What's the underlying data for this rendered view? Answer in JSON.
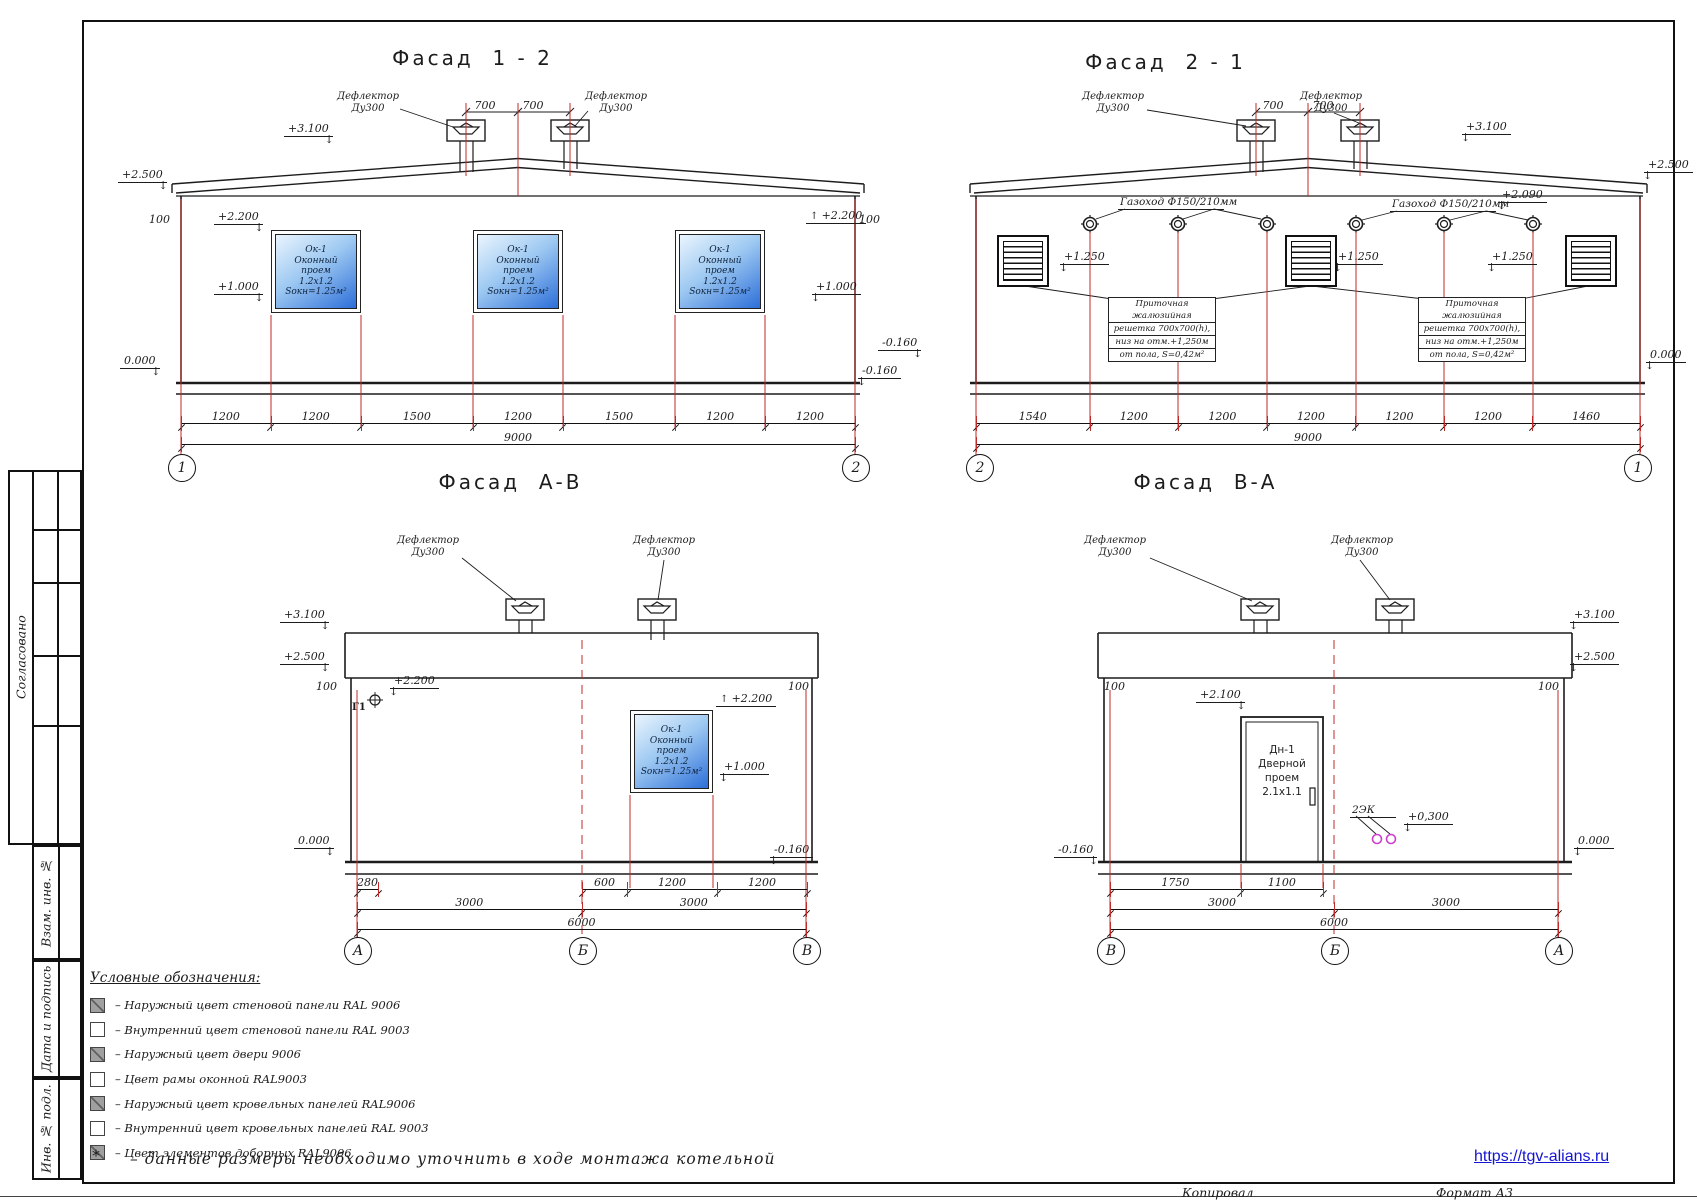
{
  "colors": {
    "axis_red": "#c22a2a",
    "magenta": "#cc3fcc",
    "window_blue_top": "#eaf5fe",
    "window_blue_bottom": "#2d6fd9",
    "link_blue": "#1515d0"
  },
  "sidebar": {
    "agreed": "Согласовано",
    "vzam": "Взам. инв. №",
    "date_sign": "Дата и подпись",
    "inv": "Инв. № подл."
  },
  "legend": {
    "title": "Условные обозначения:",
    "items": [
      {
        "swatch": "gray",
        "label": "–  Наружный цвет стеновой панели RAL 9006"
      },
      {
        "swatch": "white",
        "label": "–  Внутренний цвет стеновой панели RAL  9003"
      },
      {
        "swatch": "gray",
        "label": "–  Наружный цвет двери 9006"
      },
      {
        "swatch": "white",
        "label": "–  Цвет рамы оконной RAL9003"
      },
      {
        "swatch": "gray",
        "label": "–  Наружный цвет кровельных панелей  RAL9006"
      },
      {
        "swatch": "white",
        "label": "–  Внутренний цвет кровельных панелей RAL 9003"
      },
      {
        "swatch": "gray",
        "label": "–  Цвет элементов доборных RAL9006"
      }
    ]
  },
  "windows": [
    {
      "x": 271,
      "y": 230,
      "w": 90,
      "h": 83,
      "lines": [
        "Ок-1",
        "Оконный",
        "проем",
        "1.2х1.2",
        "Sокн=1.25м²"
      ]
    },
    {
      "x": 473,
      "y": 230,
      "w": 90,
      "h": 83,
      "lines": [
        "Ок-1",
        "Оконный",
        "проем",
        "1.2х1.2",
        "Sокн=1.25м²"
      ]
    },
    {
      "x": 675,
      "y": 230,
      "w": 90,
      "h": 83,
      "lines": [
        "Ок-1",
        "Оконный",
        "проем",
        "1.2х1.2",
        "Sокн=1.25м²"
      ]
    },
    {
      "x": 630,
      "y": 710,
      "w": 83,
      "h": 83,
      "lines": [
        "Ок-1",
        "Оконный",
        "проем",
        "1.2х1.2",
        "Sокн=1.25м²"
      ]
    }
  ],
  "door": {
    "x": 1241,
    "y": 717,
    "w": 82,
    "h": 145,
    "lines": [
      "Дн-1",
      "Дверной",
      "проем",
      "2.1х1.1"
    ]
  },
  "grilles": [
    {
      "x": 997,
      "y": 235
    },
    {
      "x": 1285,
      "y": 235
    },
    {
      "x": 1565,
      "y": 235
    }
  ],
  "callouts": [
    {
      "x": 1108,
      "y": 297,
      "rows": [
        "Приточная жалюзийная",
        "решетка 700х700(h),",
        "низ на отм.+1,250м",
        "от пола, S=0,42м²"
      ]
    },
    {
      "x": 1418,
      "y": 297,
      "rows": [
        "Приточная жалюзийная",
        "решетка 700х700(h),",
        "низ на отм.+1,250м",
        "от пола, S=0,42м²"
      ]
    }
  ],
  "axis_markers": [
    {
      "x": 181,
      "y": 467,
      "label": "1"
    },
    {
      "x": 855,
      "y": 467,
      "label": "2"
    },
    {
      "x": 979,
      "y": 467,
      "label": "2"
    },
    {
      "x": 1637,
      "y": 467,
      "label": "1"
    },
    {
      "x": 357,
      "y": 950,
      "label": "А"
    },
    {
      "x": 582,
      "y": 950,
      "label": "Б"
    },
    {
      "x": 806,
      "y": 950,
      "label": "В"
    },
    {
      "x": 1110,
      "y": 950,
      "label": "В"
    },
    {
      "x": 1334,
      "y": 950,
      "label": "Б"
    },
    {
      "x": 1558,
      "y": 950,
      "label": "А"
    }
  ],
  "dim_rows": [
    {
      "x": 181,
      "y": 410,
      "w": 674,
      "values": [
        1200,
        1200,
        1500,
        1200,
        1500,
        1200,
        1200
      ]
    },
    {
      "x": 181,
      "y": 431,
      "w": 674,
      "values": [
        9000
      ]
    },
    {
      "x": 976,
      "y": 410,
      "w": 664,
      "values": [
        1540,
        1200,
        1200,
        1200,
        1200,
        1200,
        1460
      ]
    },
    {
      "x": 976,
      "y": 431,
      "w": 664,
      "values": [
        9000
      ]
    },
    {
      "x": 357,
      "y": 876,
      "w": 21,
      "values": [
        280
      ]
    },
    {
      "x": 582,
      "y": 876,
      "w": 225,
      "values": [
        600,
        1200,
        1200
      ]
    },
    {
      "x": 357,
      "y": 896,
      "w": 449,
      "values": [
        3000,
        3000
      ]
    },
    {
      "x": 357,
      "y": 916,
      "w": 449,
      "values": [
        6000
      ]
    },
    {
      "x": 1110,
      "y": 876,
      "w": 213,
      "values": [
        1750,
        1100
      ]
    },
    {
      "x": 1110,
      "y": 896,
      "w": 448,
      "values": [
        3000,
        3000
      ]
    },
    {
      "x": 1110,
      "y": 916,
      "w": 448,
      "values": [
        6000
      ]
    }
  ],
  "annotations": [
    {
      "n": "facade-title-1-2",
      "t": "Фасад  1 - 2",
      "x": 375,
      "y": 46,
      "w": 195,
      "cls": "title"
    },
    {
      "n": "deflector-label",
      "t": "Дефлектор\nДу300",
      "x": 336,
      "y": 91,
      "w": 64,
      "cls": "lbl"
    },
    {
      "n": "deflector-label",
      "t": "Дефлектор\nДу300",
      "x": 584,
      "y": 91,
      "w": 64,
      "cls": "lbl"
    },
    {
      "n": "dim-700",
      "t": "700",
      "x": 470,
      "y": 99,
      "w": 30,
      "cls": "dimn"
    },
    {
      "n": "dim-700",
      "t": "700",
      "x": 518,
      "y": 99,
      "w": 30,
      "cls": "dimn"
    },
    {
      "n": "elevation-mark",
      "t": "+3.100",
      "x": 284,
      "y": 122,
      "cls": "elev arrR"
    },
    {
      "n": "elevation-mark",
      "t": "+2.500",
      "x": 118,
      "y": 168,
      "cls": "elev arrR"
    },
    {
      "n": "dim-100",
      "t": "100",
      "x": 149,
      "y": 213,
      "cls": "dimn"
    },
    {
      "n": "elevation-mark",
      "t": "+2.200",
      "x": 214,
      "y": 210,
      "cls": "elev arrR"
    },
    {
      "n": "elevation-mark",
      "t": "+2.200",
      "x": 806,
      "y": 209,
      "cls": "elev upf"
    },
    {
      "n": "dim-100",
      "t": "100",
      "x": 859,
      "y": 213,
      "cls": "dimn"
    },
    {
      "n": "elevation-mark",
      "t": "+1.000",
      "x": 214,
      "y": 280,
      "cls": "elev arrR"
    },
    {
      "n": "elevation-mark",
      "t": "+1.000",
      "x": 812,
      "y": 280,
      "cls": "elev arrL"
    },
    {
      "n": "elevation-mark",
      "t": "0.000",
      "x": 120,
      "y": 354,
      "cls": "elev arrR"
    },
    {
      "n": "elevation-mark",
      "t": "-0.160",
      "x": 858,
      "y": 364,
      "cls": "elev arrL"
    },
    {
      "n": "facade-title-2-1",
      "t": "Фасад  2 - 1",
      "x": 1068,
      "y": 50,
      "w": 195,
      "cls": "title"
    },
    {
      "n": "deflector-label",
      "t": "Дефлектор\nДу300",
      "x": 1080,
      "y": 91,
      "w": 66,
      "cls": "lbl"
    },
    {
      "n": "deflector-label",
      "t": "Дефлектор\nДу300",
      "x": 1298,
      "y": 91,
      "w": 66,
      "cls": "lbl"
    },
    {
      "n": "dim-700",
      "t": "700",
      "x": 1258,
      "y": 99,
      "w": 30,
      "cls": "dimn"
    },
    {
      "n": "dim-700",
      "t": "700",
      "x": 1308,
      "y": 99,
      "w": 30,
      "cls": "dimn"
    },
    {
      "n": "elevation-mark",
      "t": "+3.100",
      "x": 1462,
      "y": 120,
      "cls": "elev arrL"
    },
    {
      "n": "elevation-mark",
      "t": "+2.500",
      "x": 1644,
      "y": 158,
      "cls": "elev arrL"
    },
    {
      "n": "gas-duct-label",
      "t": "Газоход Ф150/210мм",
      "x": 1118,
      "y": 196,
      "w": 102,
      "cls": "ulbl"
    },
    {
      "n": "gas-duct-label",
      "t": "Газоход Ф150/210мм",
      "x": 1390,
      "y": 198,
      "w": 102,
      "cls": "ulbl"
    },
    {
      "n": "elevation-mark",
      "t": "+2.090",
      "x": 1498,
      "y": 188,
      "cls": "elev arrL"
    },
    {
      "n": "elevation-mark",
      "t": "+1.250",
      "x": 1060,
      "y": 250,
      "cls": "elev arrL"
    },
    {
      "n": "elevation-mark",
      "t": "+1.250",
      "x": 1334,
      "y": 250,
      "cls": "elev arrL"
    },
    {
      "n": "elevation-mark",
      "t": "+1.250",
      "x": 1488,
      "y": 250,
      "cls": "elev arrL"
    },
    {
      "n": "elevation-mark",
      "t": "-0.160",
      "x": 878,
      "y": 336,
      "cls": "elev arrR"
    },
    {
      "n": "elevation-mark",
      "t": "0.000",
      "x": 1646,
      "y": 348,
      "cls": "elev arrL"
    },
    {
      "n": "facade-title-a-v",
      "t": "Фасад  А-В",
      "x": 418,
      "y": 470,
      "w": 185,
      "cls": "title"
    },
    {
      "n": "deflector-label",
      "t": "Дефлектор\nДу300",
      "x": 396,
      "y": 535,
      "w": 64,
      "cls": "lbl"
    },
    {
      "n": "deflector-label",
      "t": "Дефлектор\nДу300",
      "x": 632,
      "y": 535,
      "w": 64,
      "cls": "lbl"
    },
    {
      "n": "elevation-mark",
      "t": "+3.100",
      "x": 280,
      "y": 608,
      "cls": "elev arrR"
    },
    {
      "n": "elevation-mark",
      "t": "+2.500",
      "x": 280,
      "y": 650,
      "cls": "elev arrR"
    },
    {
      "n": "dim-100",
      "t": "100",
      "x": 316,
      "y": 680,
      "cls": "dimn"
    },
    {
      "n": "dim-100",
      "t": "100",
      "x": 788,
      "y": 680,
      "cls": "dimn"
    },
    {
      "n": "elevation-mark",
      "t": "+2.200",
      "x": 390,
      "y": 674,
      "cls": "elev arrL"
    },
    {
      "n": "g1-mark-label",
      "t": "Г1",
      "x": 352,
      "y": 702,
      "cls": "dimn bold"
    },
    {
      "n": "elevation-mark",
      "t": "+2.200",
      "x": 716,
      "y": 692,
      "cls": "elev upf"
    },
    {
      "n": "elevation-mark",
      "t": "+1.000",
      "x": 720,
      "y": 760,
      "cls": "elev arrL"
    },
    {
      "n": "elevation-mark",
      "t": "0.000",
      "x": 294,
      "y": 834,
      "cls": "elev arrR"
    },
    {
      "n": "elevation-mark",
      "t": "-0.160",
      "x": 770,
      "y": 843,
      "cls": "elev arrL"
    },
    {
      "n": "facade-title-v-a",
      "t": "Фасад  В-А",
      "x": 1113,
      "y": 470,
      "w": 185,
      "cls": "title"
    },
    {
      "n": "deflector-label",
      "t": "Дефлектор\nДу300",
      "x": 1083,
      "y": 535,
      "w": 64,
      "cls": "lbl"
    },
    {
      "n": "deflector-label",
      "t": "Дефлектор\nДу300",
      "x": 1330,
      "y": 535,
      "w": 64,
      "cls": "lbl"
    },
    {
      "n": "elevation-mark",
      "t": "+3.100",
      "x": 1570,
      "y": 608,
      "cls": "elev arrL"
    },
    {
      "n": "elevation-mark",
      "t": "+2.500",
      "x": 1570,
      "y": 650,
      "cls": "elev arrL"
    },
    {
      "n": "dim-100",
      "t": "100",
      "x": 1104,
      "y": 680,
      "cls": "dimn"
    },
    {
      "n": "dim-100",
      "t": "100",
      "x": 1538,
      "y": 680,
      "cls": "dimn"
    },
    {
      "n": "elevation-mark",
      "t": "+2.100",
      "x": 1196,
      "y": 688,
      "cls": "elev arrR"
    },
    {
      "n": "ek-label",
      "t": "2ЭК",
      "x": 1350,
      "y": 804,
      "w": 42,
      "cls": "ulbl"
    },
    {
      "n": "elevation-mark",
      "t": "+0,300",
      "x": 1404,
      "y": 810,
      "cls": "elev arrL"
    },
    {
      "n": "elevation-mark",
      "t": "-0.160",
      "x": 1054,
      "y": 843,
      "cls": "elev arrR"
    },
    {
      "n": "elevation-mark",
      "t": "0.000",
      "x": 1574,
      "y": 834,
      "cls": "elev arrL"
    },
    {
      "n": "site-link",
      "t": "https://tgv-alians.ru",
      "x": 1474,
      "y": 1148,
      "w": 155,
      "cls": "link"
    },
    {
      "n": "footer-copied",
      "t": "Копировал",
      "x": 1182,
      "y": 1185,
      "cls": "foot"
    },
    {
      "n": "footer-format",
      "t": "Формат А3",
      "x": 1436,
      "y": 1185,
      "cls": "foot"
    },
    {
      "n": "footnote-star",
      "t": "*",
      "x": 92,
      "y": 1146,
      "cls": "fstar"
    },
    {
      "n": "footnote",
      "t": "–  данные размеры необходимо уточнить в ходе монтажа котельной",
      "x": 130,
      "y": 1150,
      "cls": "fnote"
    }
  ]
}
